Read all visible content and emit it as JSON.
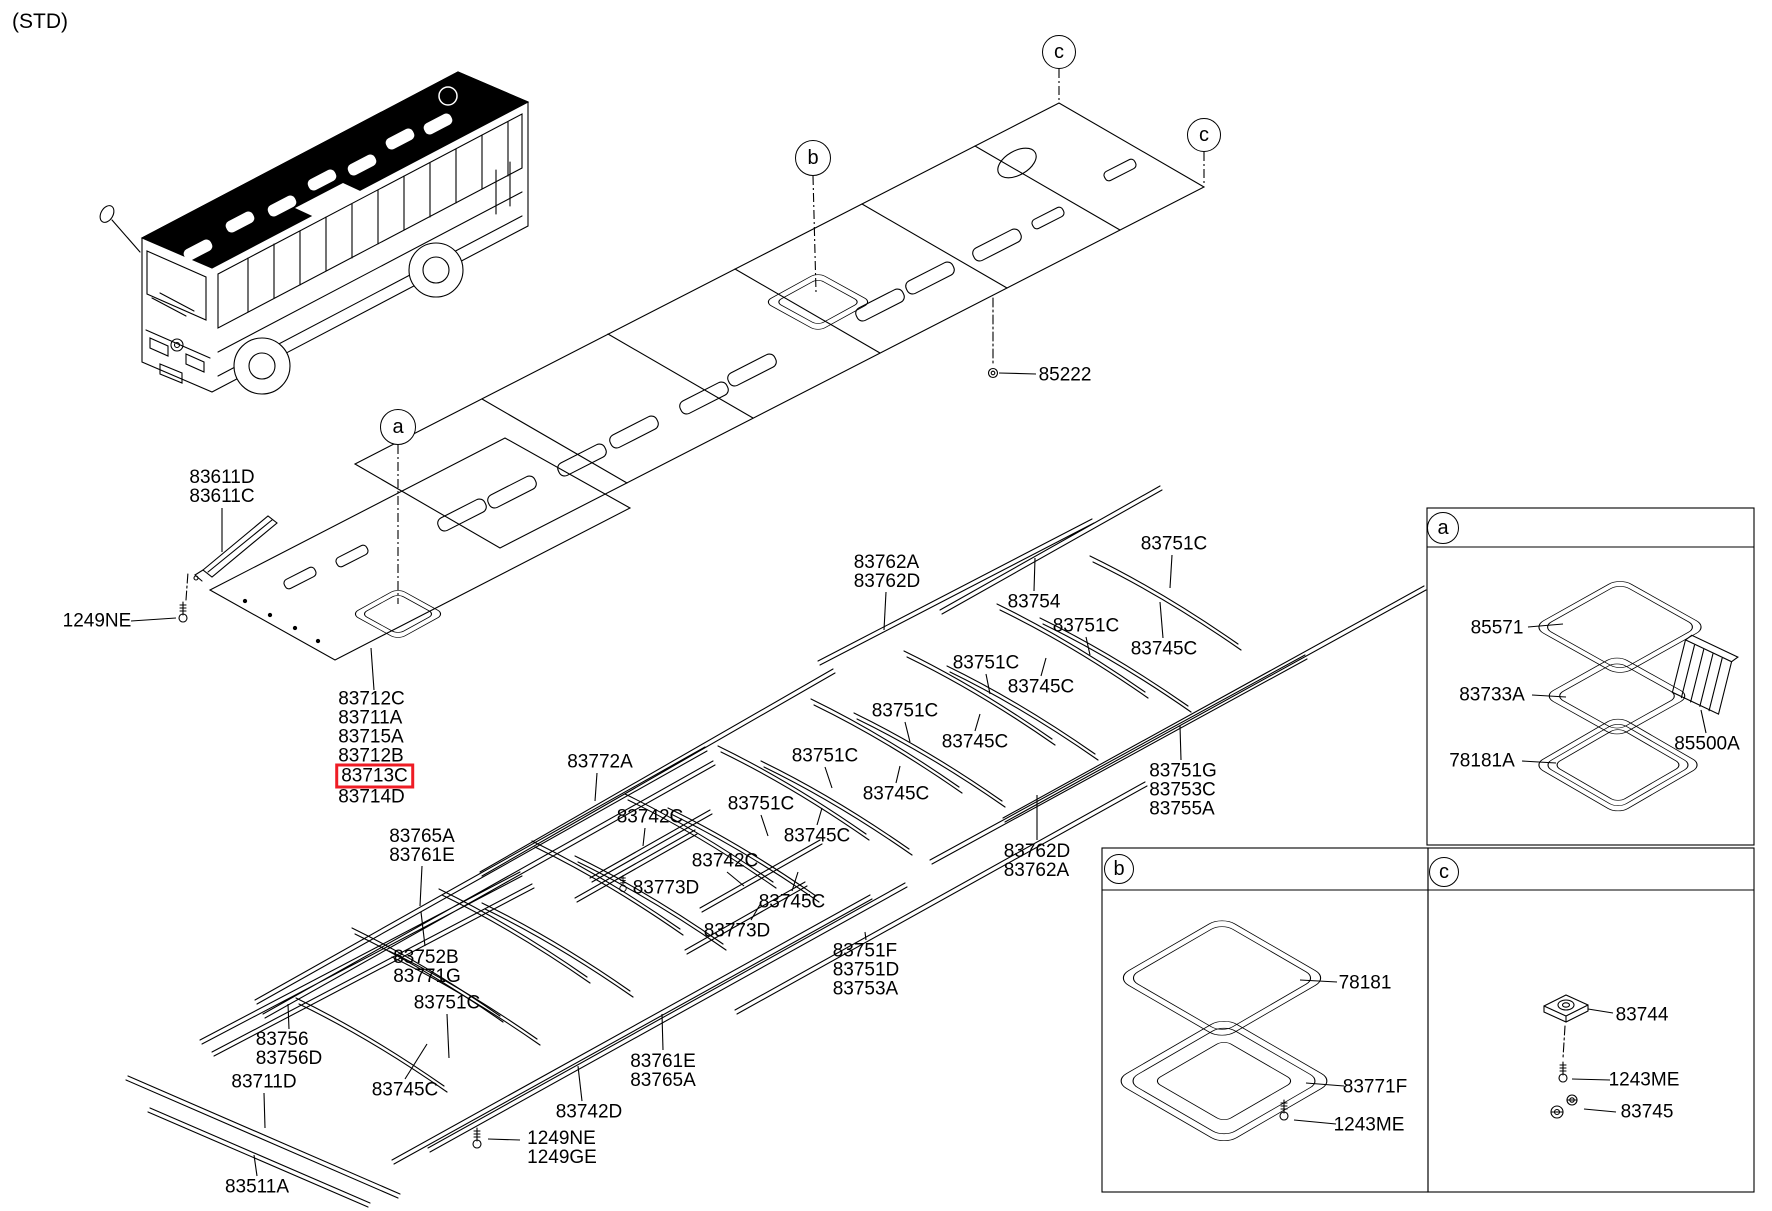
{
  "note": "(STD)",
  "colors": {
    "highlight_box": "#ee1c25",
    "line": "#000000"
  },
  "callouts": [
    {
      "letter": "a",
      "x": 398,
      "y": 427,
      "r": 17,
      "dash": [
        398,
        445,
        398,
        604
      ]
    },
    {
      "letter": "b",
      "x": 813,
      "y": 158,
      "r": 17,
      "dash": [
        813,
        176,
        816,
        292
      ]
    },
    {
      "letter": "c",
      "x": 1059,
      "y": 52,
      "r": 16,
      "dash": [
        1059,
        69,
        1059,
        100
      ]
    },
    {
      "letter": "c",
      "x": 1204,
      "y": 135,
      "r": 16,
      "dash": [
        1204,
        152,
        1204,
        184
      ]
    },
    {
      "letter": "a",
      "x": 1443,
      "y": 528,
      "r": 15
    },
    {
      "letter": "b",
      "x": 1119,
      "y": 869,
      "r": 14
    },
    {
      "letter": "c",
      "x": 1444,
      "y": 872,
      "r": 14
    }
  ],
  "labels": [
    {
      "x": 222,
      "y": 487,
      "lines": [
        "83611D",
        "83611C"
      ],
      "leader": [
        222,
        508,
        222,
        552
      ]
    },
    {
      "x": 97,
      "y": 621,
      "lines": [
        "1249NE"
      ],
      "leader": [
        131,
        621,
        176,
        618
      ]
    },
    {
      "x": 376,
      "y": 748,
      "lines": [
        "83712C",
        "83711A",
        "83715A",
        "83712B",
        "83713C",
        "83714D"
      ],
      "highlight": "83713C",
      "leader": [
        374,
        690,
        371,
        648
      ]
    },
    {
      "x": 422,
      "y": 846,
      "lines": [
        "83765A",
        "83761E"
      ],
      "leader": [
        422,
        866,
        420,
        906
      ]
    },
    {
      "x": 427,
      "y": 967,
      "lines": [
        "83752B",
        "83771G"
      ],
      "leader": [
        425,
        946,
        421,
        912
      ]
    },
    {
      "x": 447,
      "y": 1003,
      "lines": [
        "83751C"
      ],
      "leader": [
        447,
        1014,
        449,
        1058
      ]
    },
    {
      "x": 405,
      "y": 1090,
      "lines": [
        "83745C"
      ],
      "leader": [
        405,
        1079,
        427,
        1044
      ]
    },
    {
      "x": 289,
      "y": 1049,
      "lines": [
        "83756",
        "83756D"
      ],
      "leader": [
        289,
        1029,
        288,
        1004
      ]
    },
    {
      "x": 264,
      "y": 1082,
      "lines": [
        "83711D"
      ],
      "leader": [
        264,
        1093,
        265,
        1128
      ]
    },
    {
      "x": 257,
      "y": 1187,
      "lines": [
        "83511A"
      ],
      "leader": [
        257,
        1176,
        254,
        1155
      ]
    },
    {
      "x": 562,
      "y": 1148,
      "lines": [
        "1249NE",
        "1249GE"
      ],
      "leader": [
        520,
        1140,
        488,
        1139
      ]
    },
    {
      "x": 589,
      "y": 1112,
      "lines": [
        "83742D"
      ],
      "leader": [
        582,
        1101,
        578,
        1066
      ]
    },
    {
      "x": 663,
      "y": 1071,
      "lines": [
        "83761E",
        "83765A"
      ],
      "leader": [
        663,
        1050,
        662,
        1014
      ]
    },
    {
      "x": 866,
      "y": 970,
      "lines": [
        "83751F",
        "83751D",
        "83753A"
      ],
      "leader": [
        866,
        940,
        865,
        932
      ]
    },
    {
      "x": 600,
      "y": 762,
      "lines": [
        "83772A"
      ],
      "leader": [
        597,
        773,
        595,
        801
      ]
    },
    {
      "x": 650,
      "y": 817,
      "lines": [
        "83742C"
      ],
      "leader": [
        645,
        828,
        643,
        846
      ]
    },
    {
      "x": 666,
      "y": 888,
      "lines": [
        "83773D"
      ]
    },
    {
      "x": 725,
      "y": 861,
      "lines": [
        "83742C"
      ],
      "leader": [
        727,
        872,
        744,
        886
      ]
    },
    {
      "x": 737,
      "y": 931,
      "lines": [
        "83773D"
      ],
      "leader": [
        751,
        920,
        761,
        903
      ]
    },
    {
      "x": 792,
      "y": 902,
      "lines": [
        "83745C"
      ],
      "leader": [
        792,
        891,
        798,
        872
      ]
    },
    {
      "x": 761,
      "y": 804,
      "lines": [
        "83751C"
      ],
      "leader": [
        761,
        815,
        768,
        836
      ]
    },
    {
      "x": 825,
      "y": 756,
      "lines": [
        "83751C"
      ],
      "leader": [
        825,
        767,
        832,
        788
      ]
    },
    {
      "x": 817,
      "y": 836,
      "lines": [
        "83745C"
      ],
      "leader": [
        817,
        825,
        822,
        808
      ]
    },
    {
      "x": 896,
      "y": 794,
      "lines": [
        "83745C"
      ],
      "leader": [
        896,
        783,
        900,
        766
      ]
    },
    {
      "x": 905,
      "y": 711,
      "lines": [
        "83751C"
      ],
      "leader": [
        905,
        722,
        910,
        742
      ]
    },
    {
      "x": 986,
      "y": 663,
      "lines": [
        "83751C"
      ],
      "leader": [
        986,
        674,
        990,
        694
      ]
    },
    {
      "x": 975,
      "y": 742,
      "lines": [
        "83745C"
      ],
      "leader": [
        975,
        731,
        980,
        714
      ]
    },
    {
      "x": 1041,
      "y": 687,
      "lines": [
        "83745C"
      ],
      "leader": [
        1041,
        676,
        1046,
        658
      ]
    },
    {
      "x": 1086,
      "y": 626,
      "lines": [
        "83751C"
      ],
      "leader": [
        1086,
        637,
        1090,
        655
      ]
    },
    {
      "x": 1164,
      "y": 649,
      "lines": [
        "83745C"
      ],
      "leader": [
        1163,
        638,
        1160,
        602
      ]
    },
    {
      "x": 1174,
      "y": 544,
      "lines": [
        "83751C"
      ],
      "leader": [
        1172,
        555,
        1170,
        588
      ]
    },
    {
      "x": 1034,
      "y": 602,
      "lines": [
        "83754"
      ],
      "leader": [
        1034,
        591,
        1035,
        558
      ]
    },
    {
      "x": 887,
      "y": 572,
      "lines": [
        "83762A",
        "83762D"
      ],
      "leader": [
        886,
        592,
        884,
        630
      ]
    },
    {
      "x": 1065,
      "y": 375,
      "lines": [
        "85222"
      ],
      "leader": [
        1036,
        374,
        999,
        373
      ]
    },
    {
      "x": 1037,
      "y": 861,
      "lines": [
        "83762D",
        "83762A"
      ],
      "leader": [
        1037,
        840,
        1037,
        795
      ]
    },
    {
      "x": 1183,
      "y": 790,
      "lines": [
        "83751G",
        "83753C",
        "83755A"
      ],
      "leader": [
        1181,
        760,
        1180,
        726
      ]
    },
    {
      "x": 1497,
      "y": 628,
      "lines": [
        "85571"
      ],
      "leader": [
        1528,
        627,
        1563,
        624
      ]
    },
    {
      "x": 1492,
      "y": 695,
      "lines": [
        "83733A"
      ],
      "leader": [
        1532,
        695,
        1566,
        697
      ]
    },
    {
      "x": 1482,
      "y": 761,
      "lines": [
        "78181A"
      ],
      "leader": [
        1522,
        761,
        1556,
        763
      ]
    },
    {
      "x": 1707,
      "y": 744,
      "lines": [
        "85500A"
      ],
      "leader": [
        1706,
        733,
        1701,
        710
      ]
    },
    {
      "x": 1365,
      "y": 983,
      "lines": [
        "78181"
      ],
      "leader": [
        1337,
        982,
        1300,
        980
      ]
    },
    {
      "x": 1375,
      "y": 1087,
      "lines": [
        "83771F"
      ],
      "leader": [
        1344,
        1086,
        1306,
        1083
      ]
    },
    {
      "x": 1369,
      "y": 1125,
      "lines": [
        "1243ME"
      ],
      "leader": [
        1336,
        1124,
        1294,
        1120
      ]
    },
    {
      "x": 1642,
      "y": 1015,
      "lines": [
        "83744"
      ],
      "leader": [
        1613,
        1013,
        1588,
        1009
      ]
    },
    {
      "x": 1644,
      "y": 1080,
      "lines": [
        "1243ME"
      ],
      "leader": [
        1610,
        1080,
        1572,
        1079
      ]
    },
    {
      "x": 1647,
      "y": 1112,
      "lines": [
        "83745"
      ],
      "leader": [
        1616,
        1112,
        1584,
        1109
      ]
    }
  ]
}
